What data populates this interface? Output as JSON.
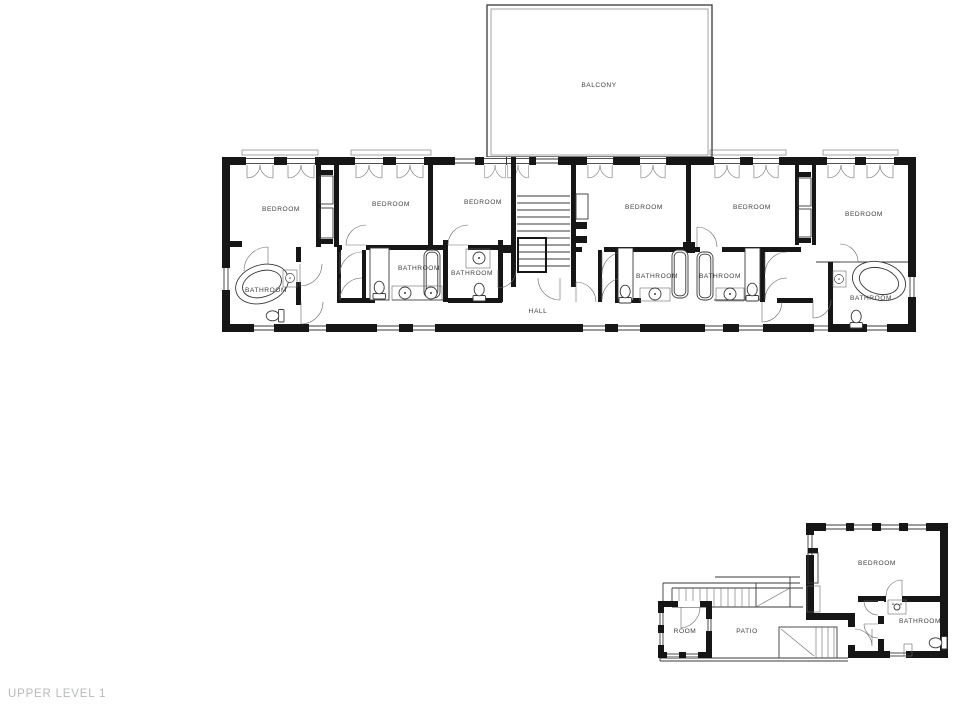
{
  "footer": {
    "level_label": "UPPER LEVEL 1"
  },
  "colors": {
    "wall": "#161616",
    "thin_line": "#3a3a3a",
    "room_label_text": "#414141",
    "level_label_text": "#b7babc",
    "background": "#ffffff"
  },
  "main_building": {
    "balcony_label": "BALCONY",
    "hall_label": "HALL",
    "bedrooms": {
      "b1": "BEDROOM",
      "b2": "BEDROOM",
      "b3": "BEDROOM",
      "b4": "BEDROOM",
      "b5": "BEDROOM",
      "b6": "BEDROOM"
    },
    "bathrooms": {
      "b1": "BATHROOM",
      "b2": "BATHROOM",
      "b3": "BATHROOM",
      "b4": "BATHROOM",
      "b5": "BATHROOM",
      "b6": "BATHROOM"
    }
  },
  "annex": {
    "bedroom_label": "BEDROOM",
    "bathroom_label": "BATHROOM",
    "room_label": "ROOM",
    "patio_label": "PATIO"
  }
}
